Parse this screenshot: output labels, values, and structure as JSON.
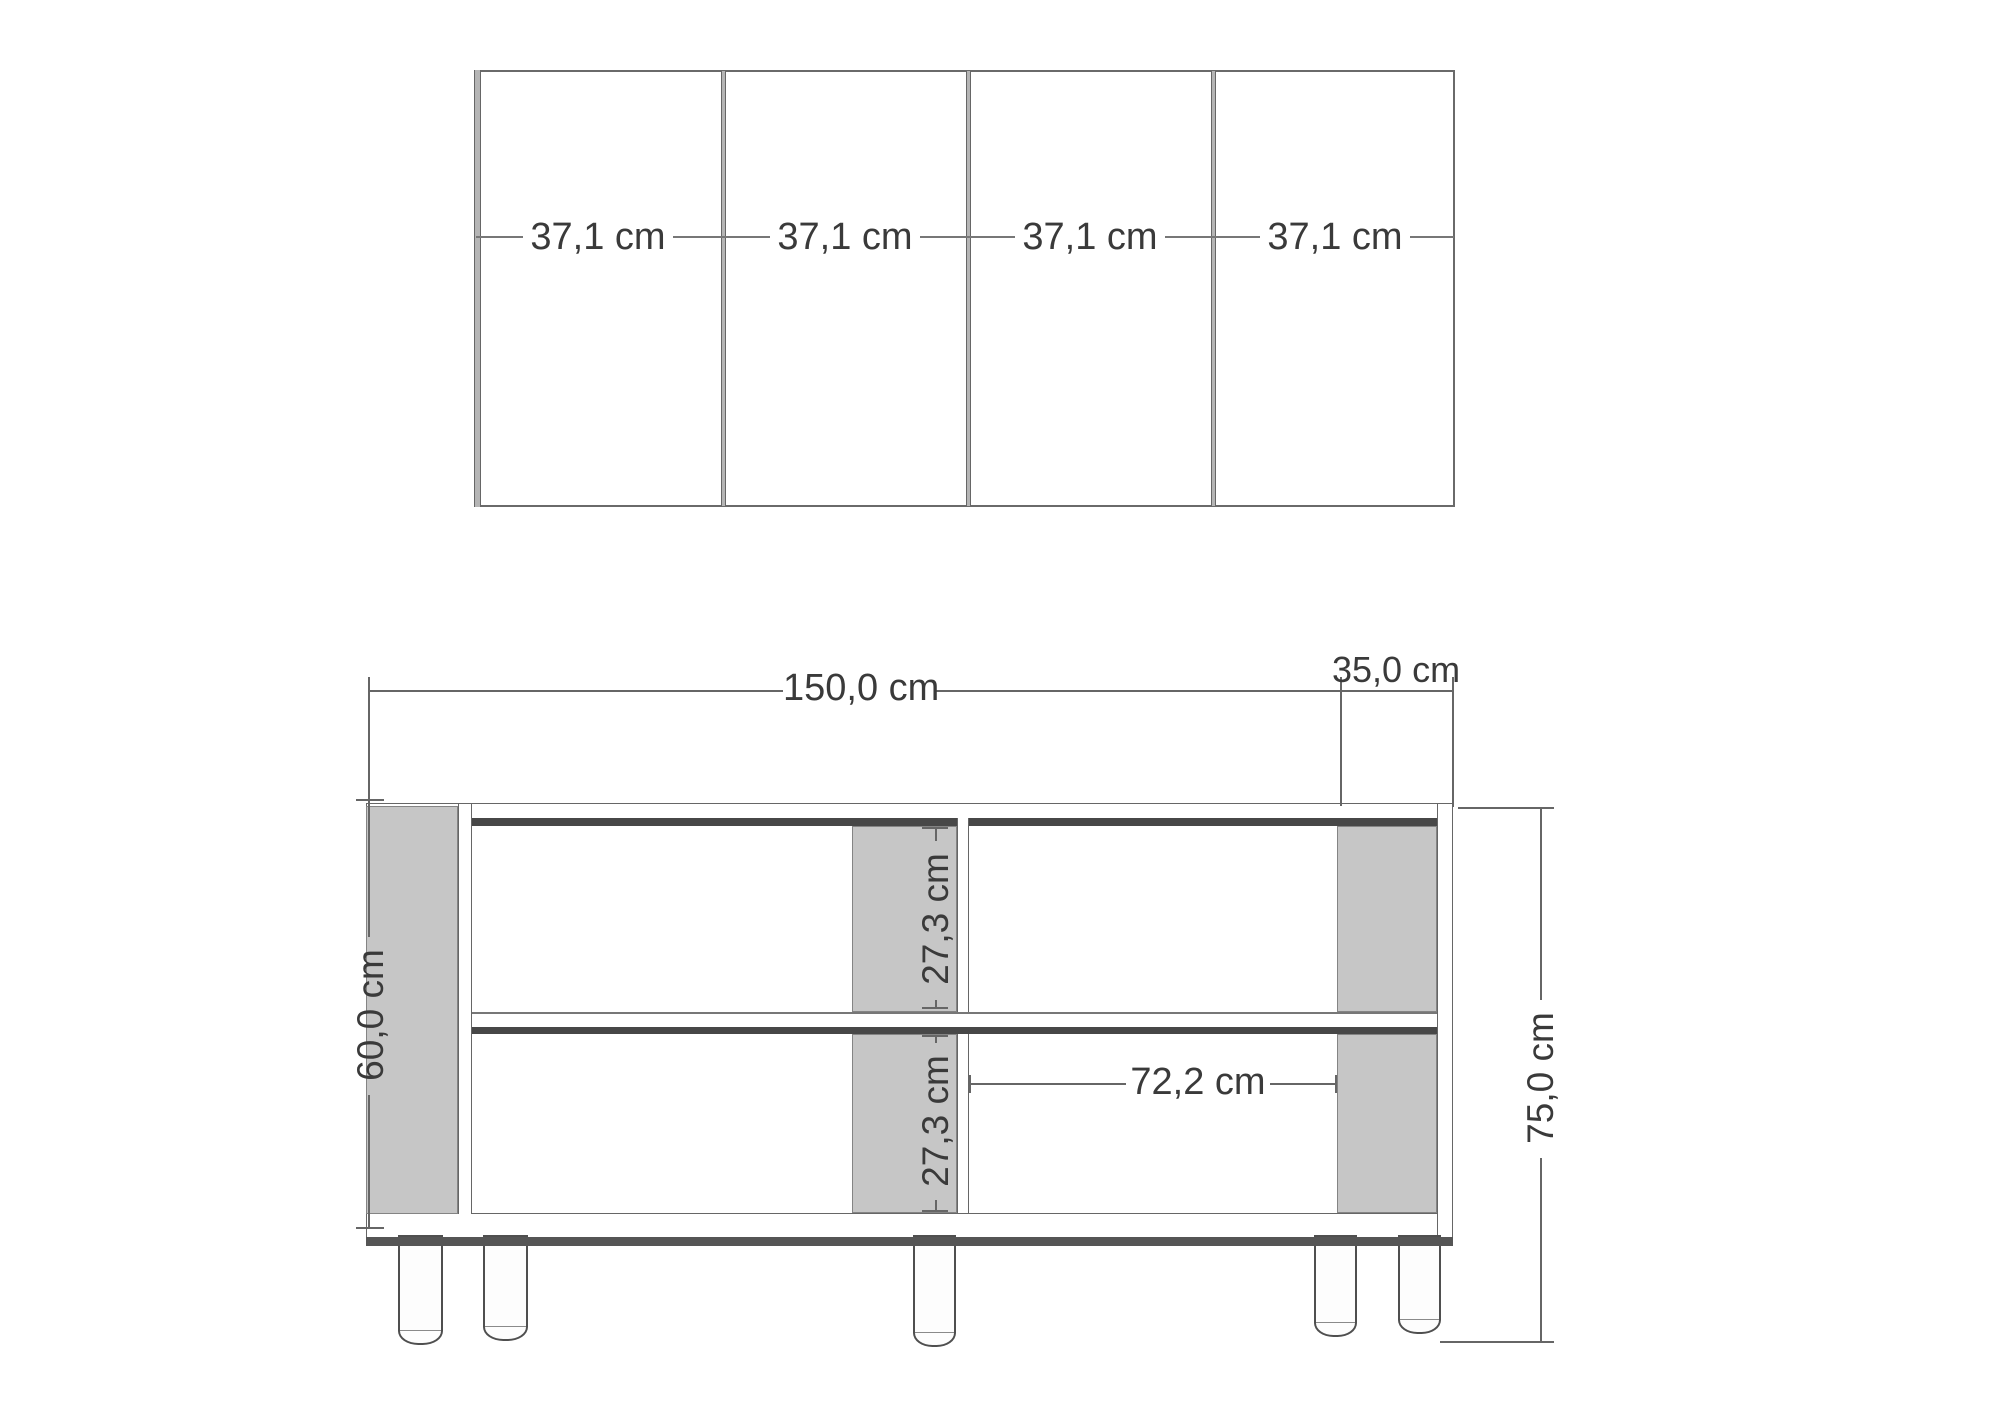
{
  "drawing": {
    "type": "furniture dimension drawing",
    "colors": {
      "background": "#ffffff",
      "panel_gray": "#c6c6c6",
      "dark_band": "#474747",
      "line": "#666666",
      "text": "#3a3a3a"
    },
    "plan_view": {
      "bay_labels": [
        "37,1 cm",
        "37,1 cm",
        "37,1 cm",
        "37,1 cm"
      ]
    },
    "front_view": {
      "width_label": "150,0 cm",
      "depth_label": "35,0 cm",
      "side_height_label": "60,0 cm",
      "upper_compartment_label": "27,3 cm",
      "lower_compartment_label": "27,3 cm",
      "shelf_width_label": "72,2 cm",
      "total_height_label": "75,0 cm"
    }
  }
}
